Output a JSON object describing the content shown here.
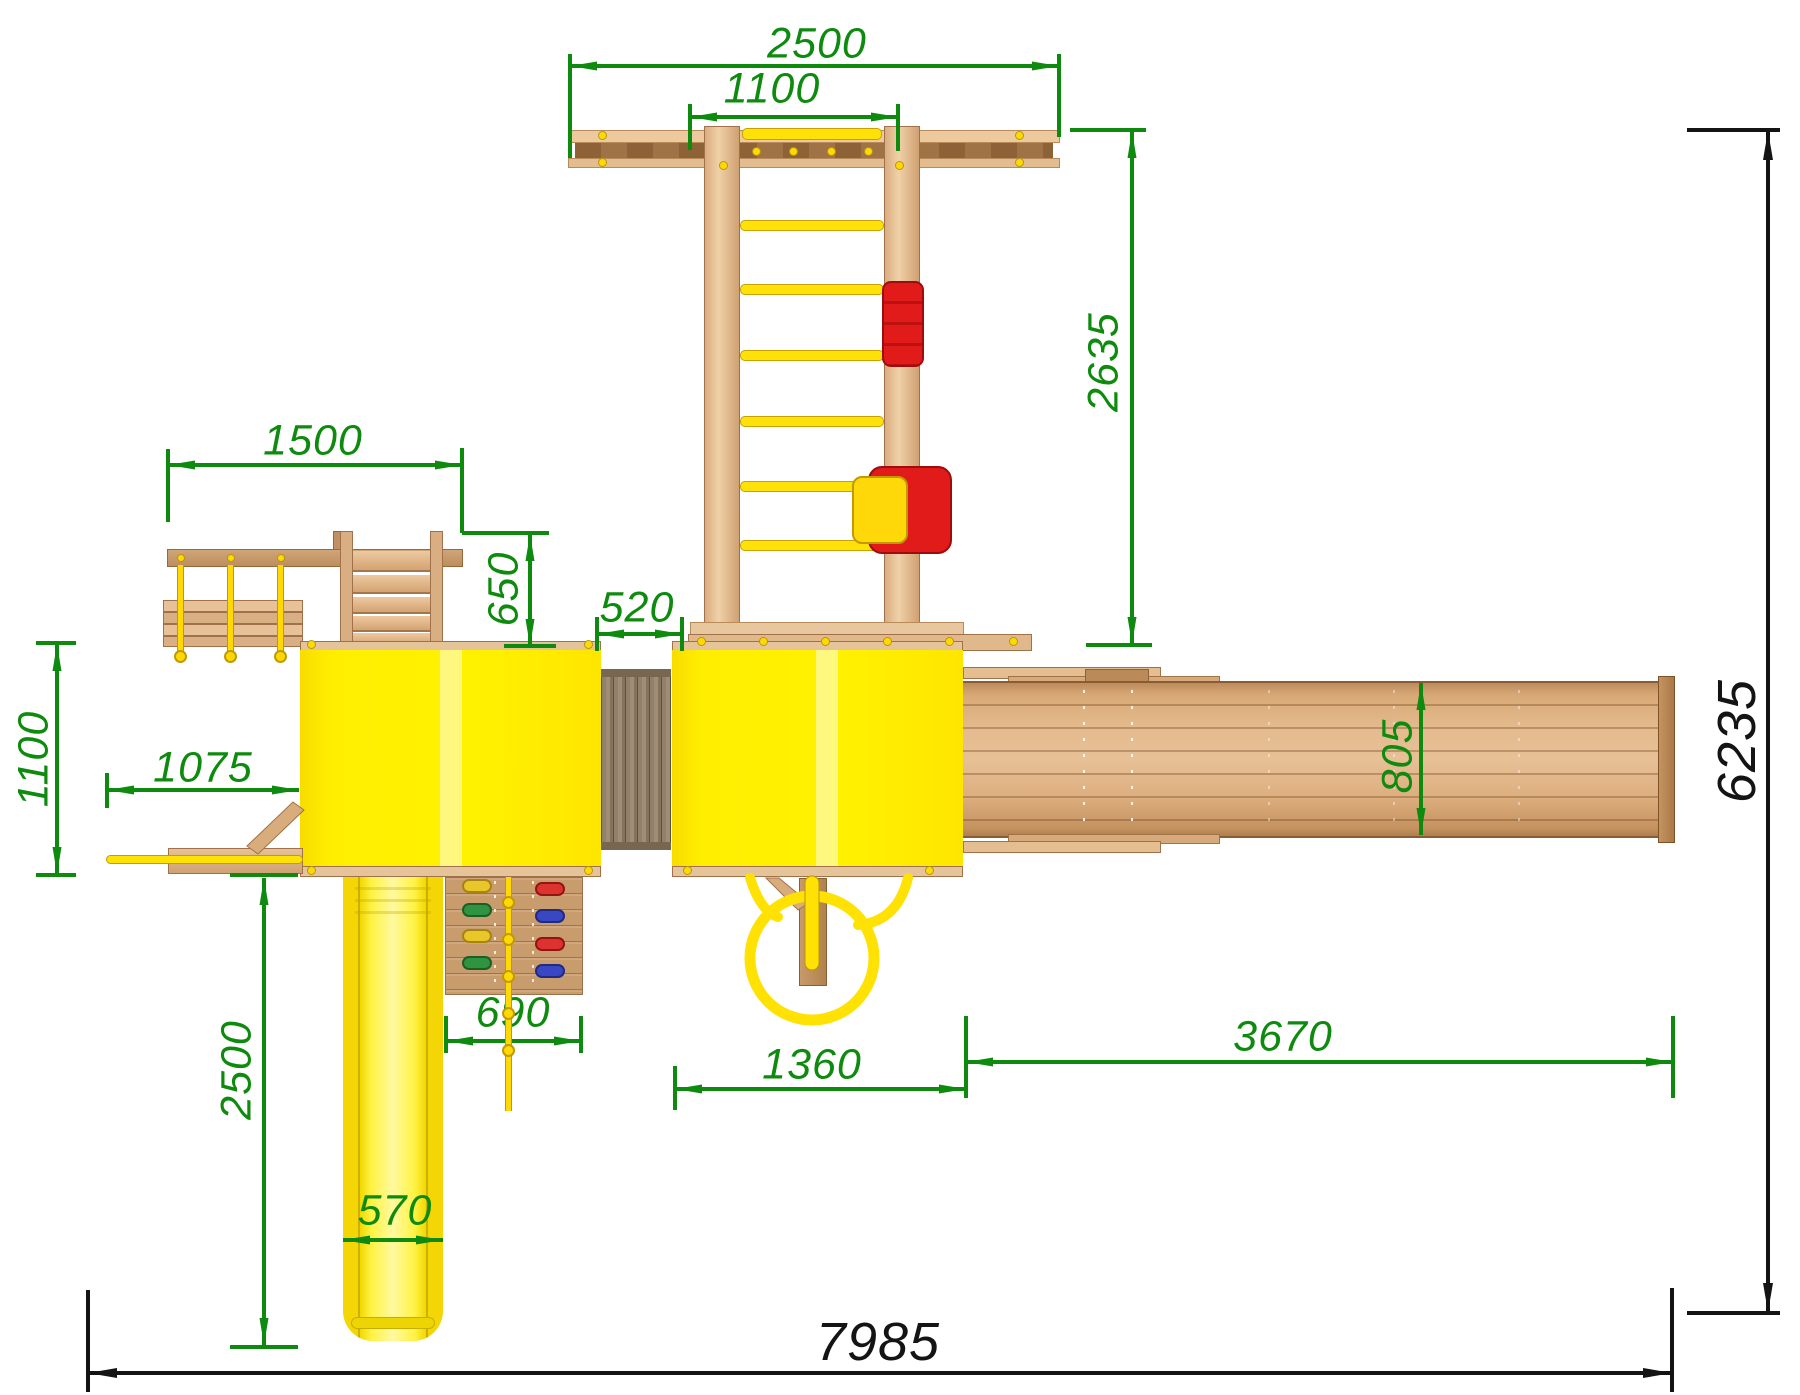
{
  "drawing_type": "playground-top-view-dimension-drawing",
  "colors": {
    "dimension_green": "#0e8b0e",
    "dimension_black": "#141414",
    "platform_yellow": "#ffee00",
    "slide_yellow": "#f4d606",
    "rope_yellow": "#ffd805",
    "swing_red": "#e11a1a",
    "wood_light": "#e9c9a1",
    "wood_medium": "#d8ab7c",
    "wood_dark": "#9a6a3c"
  },
  "dimensions": {
    "top_span": {
      "value": "2500",
      "orientation": "horizontal",
      "color": "green"
    },
    "swing_width": {
      "value": "1100",
      "orientation": "horizontal",
      "color": "green"
    },
    "swing_depth": {
      "value": "2635",
      "orientation": "vertical",
      "color": "green"
    },
    "left_beam": {
      "value": "1500",
      "orientation": "horizontal",
      "color": "green"
    },
    "stair_drop": {
      "value": "650",
      "orientation": "vertical",
      "color": "green"
    },
    "bridge_width": {
      "value": "520",
      "orientation": "horizontal",
      "color": "green"
    },
    "left_overhang": {
      "value": "1100",
      "orientation": "vertical",
      "color": "green"
    },
    "pole_reach": {
      "value": "1075",
      "orientation": "horizontal",
      "color": "green"
    },
    "slide_run": {
      "value": "2500",
      "orientation": "vertical",
      "color": "green"
    },
    "slide_width": {
      "value": "570",
      "orientation": "horizontal",
      "color": "green"
    },
    "climb_wall_width": {
      "value": "690",
      "orientation": "horizontal",
      "color": "green"
    },
    "tower_span": {
      "value": "1360",
      "orientation": "horizontal",
      "color": "green"
    },
    "walkway_length": {
      "value": "3670",
      "orientation": "horizontal",
      "color": "green"
    },
    "walkway_width": {
      "value": "805",
      "orientation": "vertical",
      "color": "green"
    },
    "total_depth": {
      "value": "6235",
      "orientation": "vertical",
      "color": "black"
    },
    "total_width": {
      "value": "7985",
      "orientation": "horizontal",
      "color": "black"
    }
  }
}
